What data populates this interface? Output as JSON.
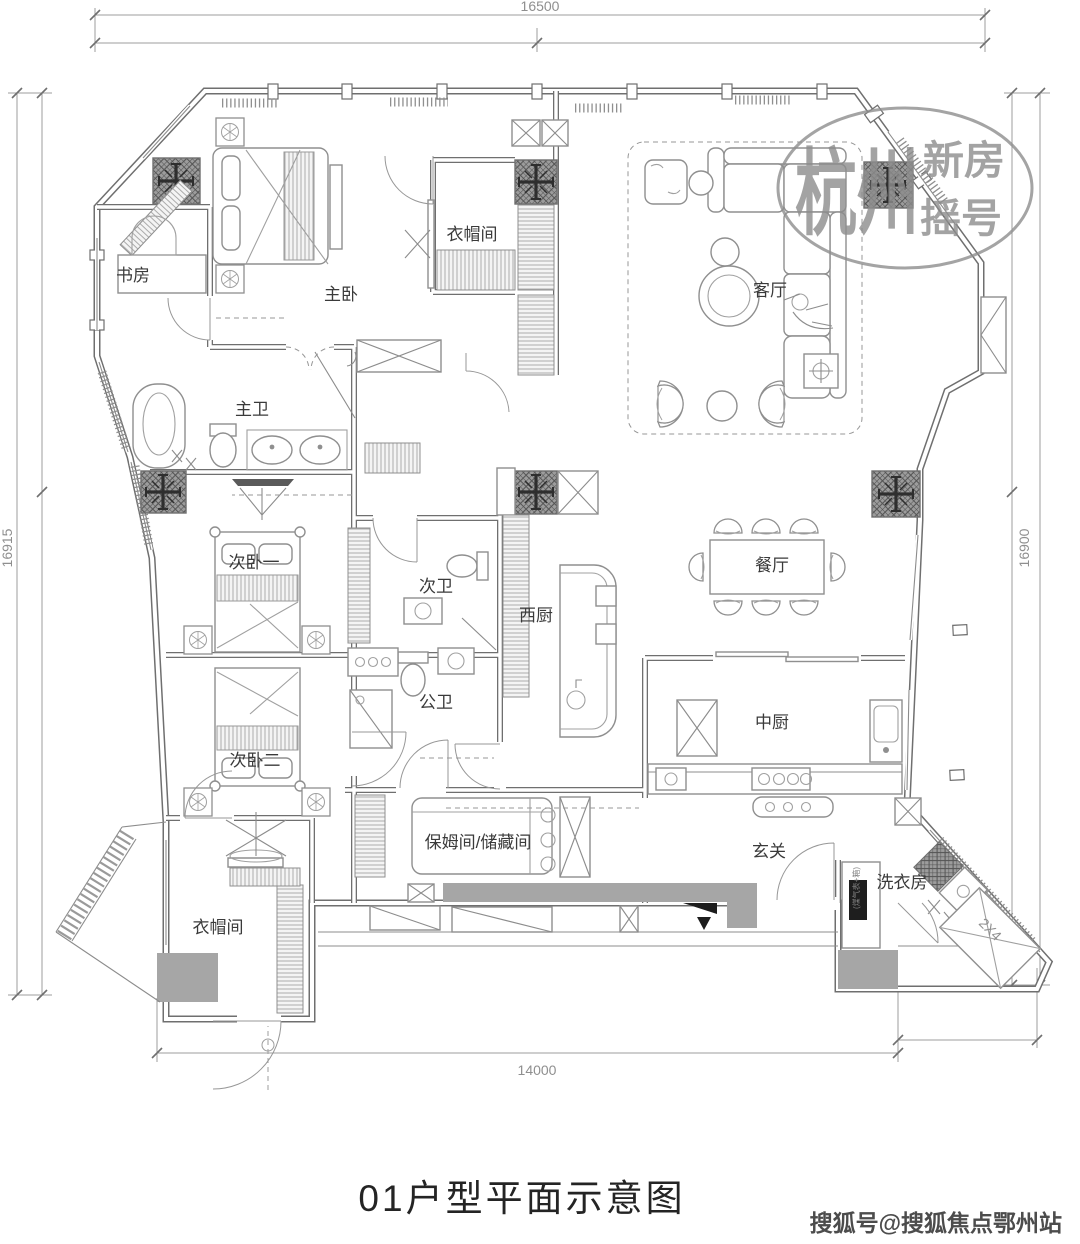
{
  "title": "01户型平面示意图",
  "dimensions": {
    "top": "16500",
    "left": "16915",
    "right": "16900",
    "bottom": "14000"
  },
  "rooms": [
    {
      "id": "study",
      "label": "书房"
    },
    {
      "id": "master-bedroom",
      "label": "主卧"
    },
    {
      "id": "cloakroom-top",
      "label": "衣帽间"
    },
    {
      "id": "living-room",
      "label": "客厅"
    },
    {
      "id": "master-bath",
      "label": "主卫"
    },
    {
      "id": "second-bedroom-1",
      "label": "次卧一"
    },
    {
      "id": "second-bath",
      "label": "次卫"
    },
    {
      "id": "west-kitchen",
      "label": "西厨"
    },
    {
      "id": "dining-room",
      "label": "餐厅"
    },
    {
      "id": "public-bath",
      "label": "公卫"
    },
    {
      "id": "second-bedroom-2",
      "label": "次卧二"
    },
    {
      "id": "chinese-kitchen",
      "label": "中厨"
    },
    {
      "id": "maid-storage-room",
      "label": "保姆间/储藏间"
    },
    {
      "id": "foyer",
      "label": "玄关"
    },
    {
      "id": "cloakroom-bottom",
      "label": "衣帽间"
    },
    {
      "id": "laundry-room",
      "label": "洗衣房"
    }
  ],
  "annotations": {
    "ac_platform": "2X4",
    "gas_meter": "(煤气表+箱)"
  },
  "watermark": {
    "brand_large": "杭州",
    "line1": "新房",
    "line2": "摇号",
    "credit": "搜狐号@搜狐焦点鄂州站"
  },
  "colors": {
    "wall": "#6f6f6f",
    "watermark": "#8d8d8d",
    "fill_gray": "#a6a6a6"
  }
}
